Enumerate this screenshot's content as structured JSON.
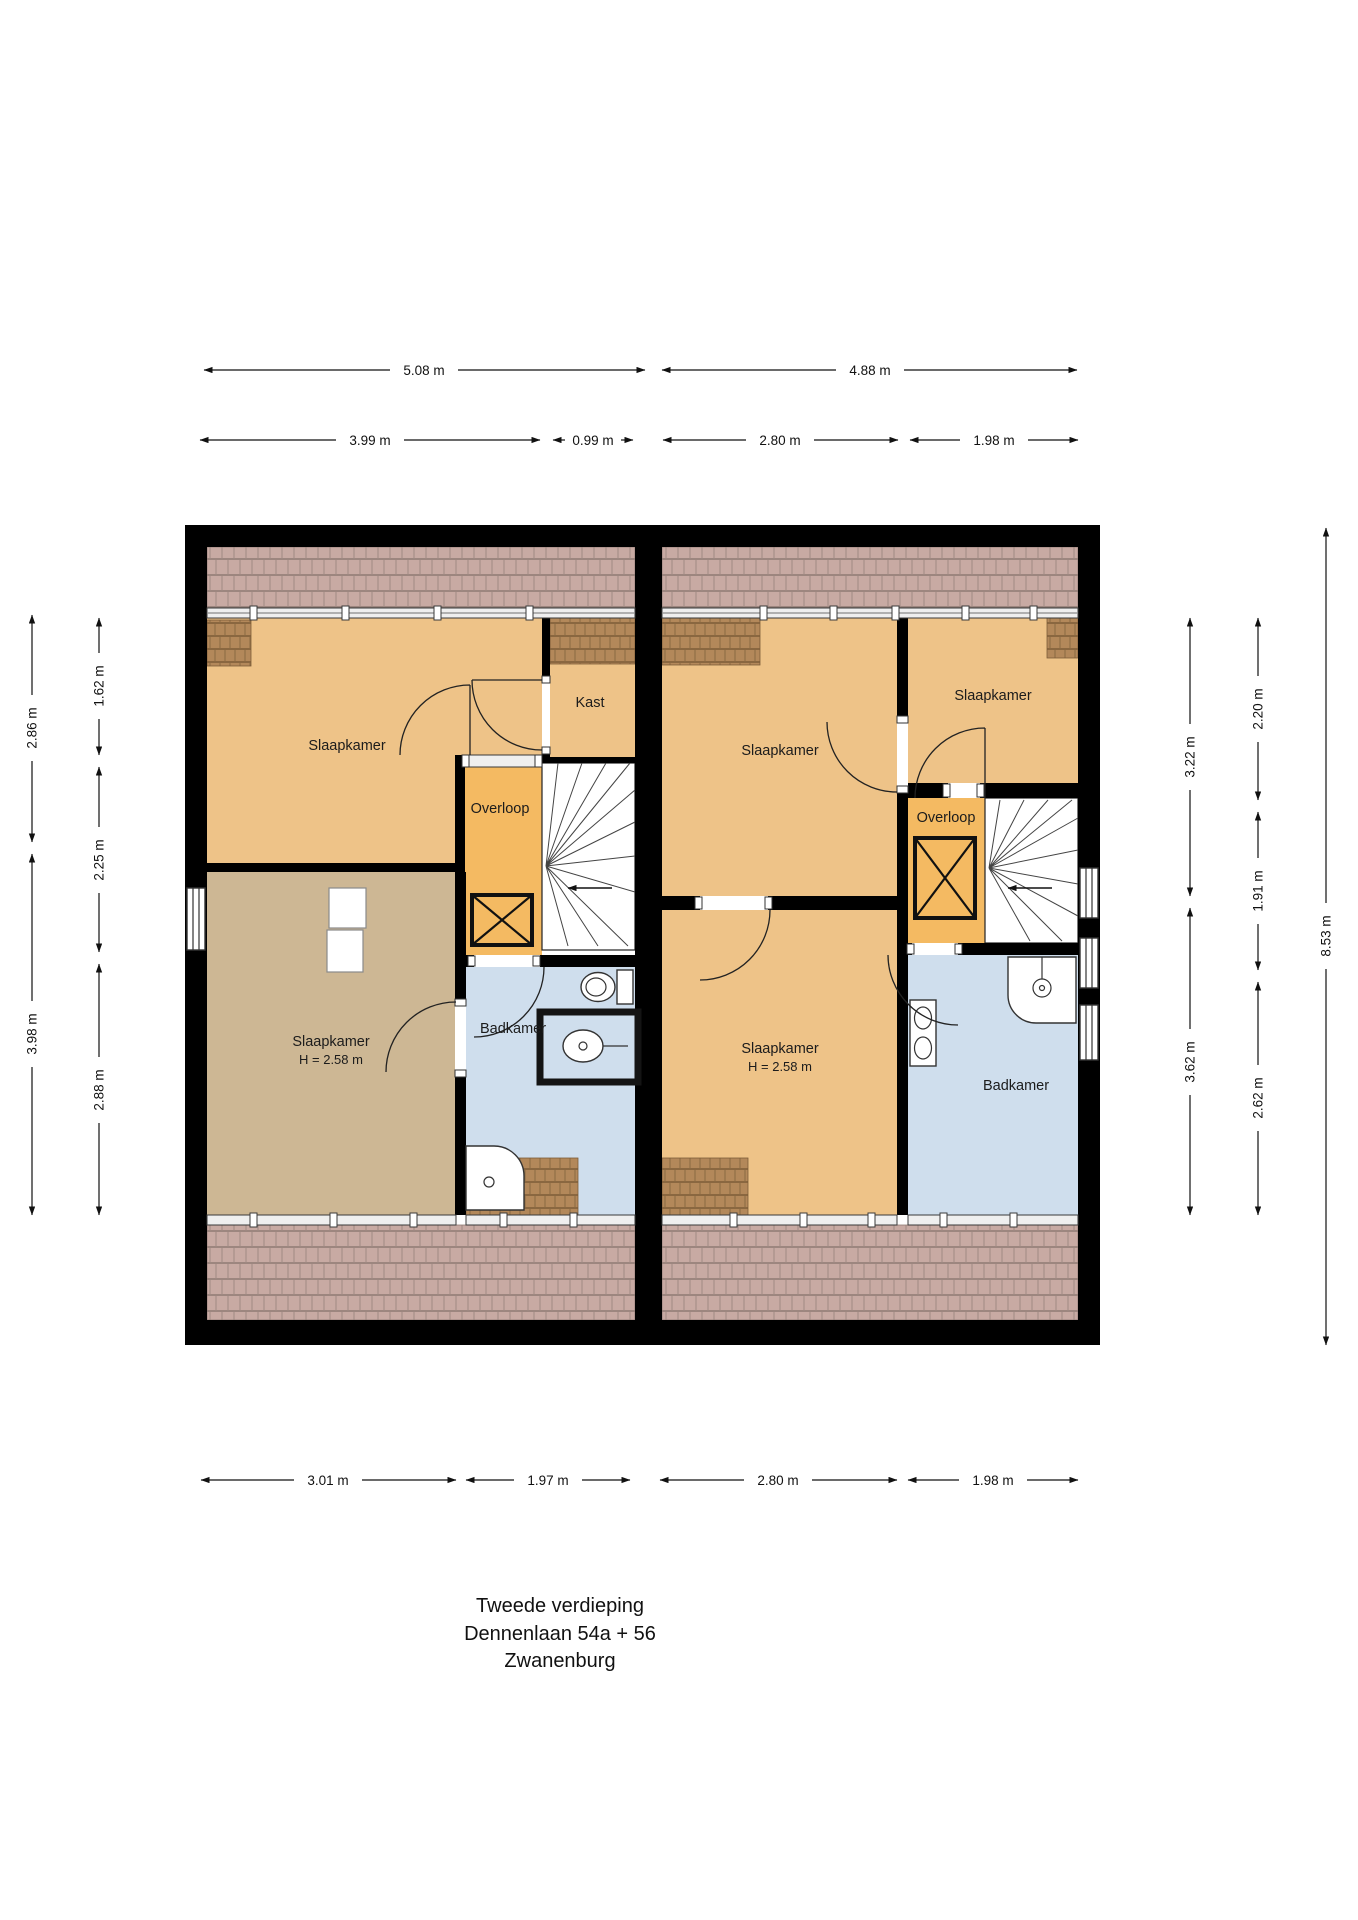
{
  "title": {
    "floor": "Tweede verdieping",
    "address": "Dennenlaan 54a + 56",
    "city": "Zwanenburg"
  },
  "rooms": {
    "left_unit": {
      "slaapkamer_top": "Slaapkamer",
      "kast": "Kast",
      "overloop": "Overloop",
      "slaapkamer_bottom": "Slaapkamer",
      "slaapkamer_bottom_note": "H = 2.58 m",
      "badkamer": "Badkamer"
    },
    "right_unit": {
      "slaapkamer_left": "Slaapkamer",
      "slaapkamer_right": "Slaapkamer",
      "overloop": "Overloop",
      "slaapkamer_bottom": "Slaapkamer",
      "slaapkamer_bottom_note": "H = 2.58 m",
      "badkamer": "Badkamer"
    }
  },
  "dimensions": {
    "top_total": [
      "5.08 m",
      "4.88 m"
    ],
    "top_segments": [
      "3.99 m",
      "0.99 m",
      "2.80 m",
      "1.98 m"
    ],
    "bottom_segments": [
      "3.01 m",
      "1.97 m",
      "2.80 m",
      "1.98 m"
    ],
    "left_total": [
      "2.86 m",
      "3.98 m"
    ],
    "left_segments": [
      "1.62 m",
      "2.25 m",
      "2.88 m"
    ],
    "right_totals": [
      "3.22 m",
      "3.62 m"
    ],
    "right_segments": [
      "2.20 m",
      "1.91 m",
      "2.62 m"
    ],
    "right_overall": "8.53 m"
  },
  "colors": {
    "wall": "#000000",
    "bedroom": "#eec388",
    "bedroom_shaded": "#cdb794",
    "hallway": "#f4ba62",
    "bathroom": "#cfdeed",
    "stairs": "#ffffff",
    "roof_tiles": "#c8aaa3",
    "roof_tiles_dark": "#b3885a"
  }
}
